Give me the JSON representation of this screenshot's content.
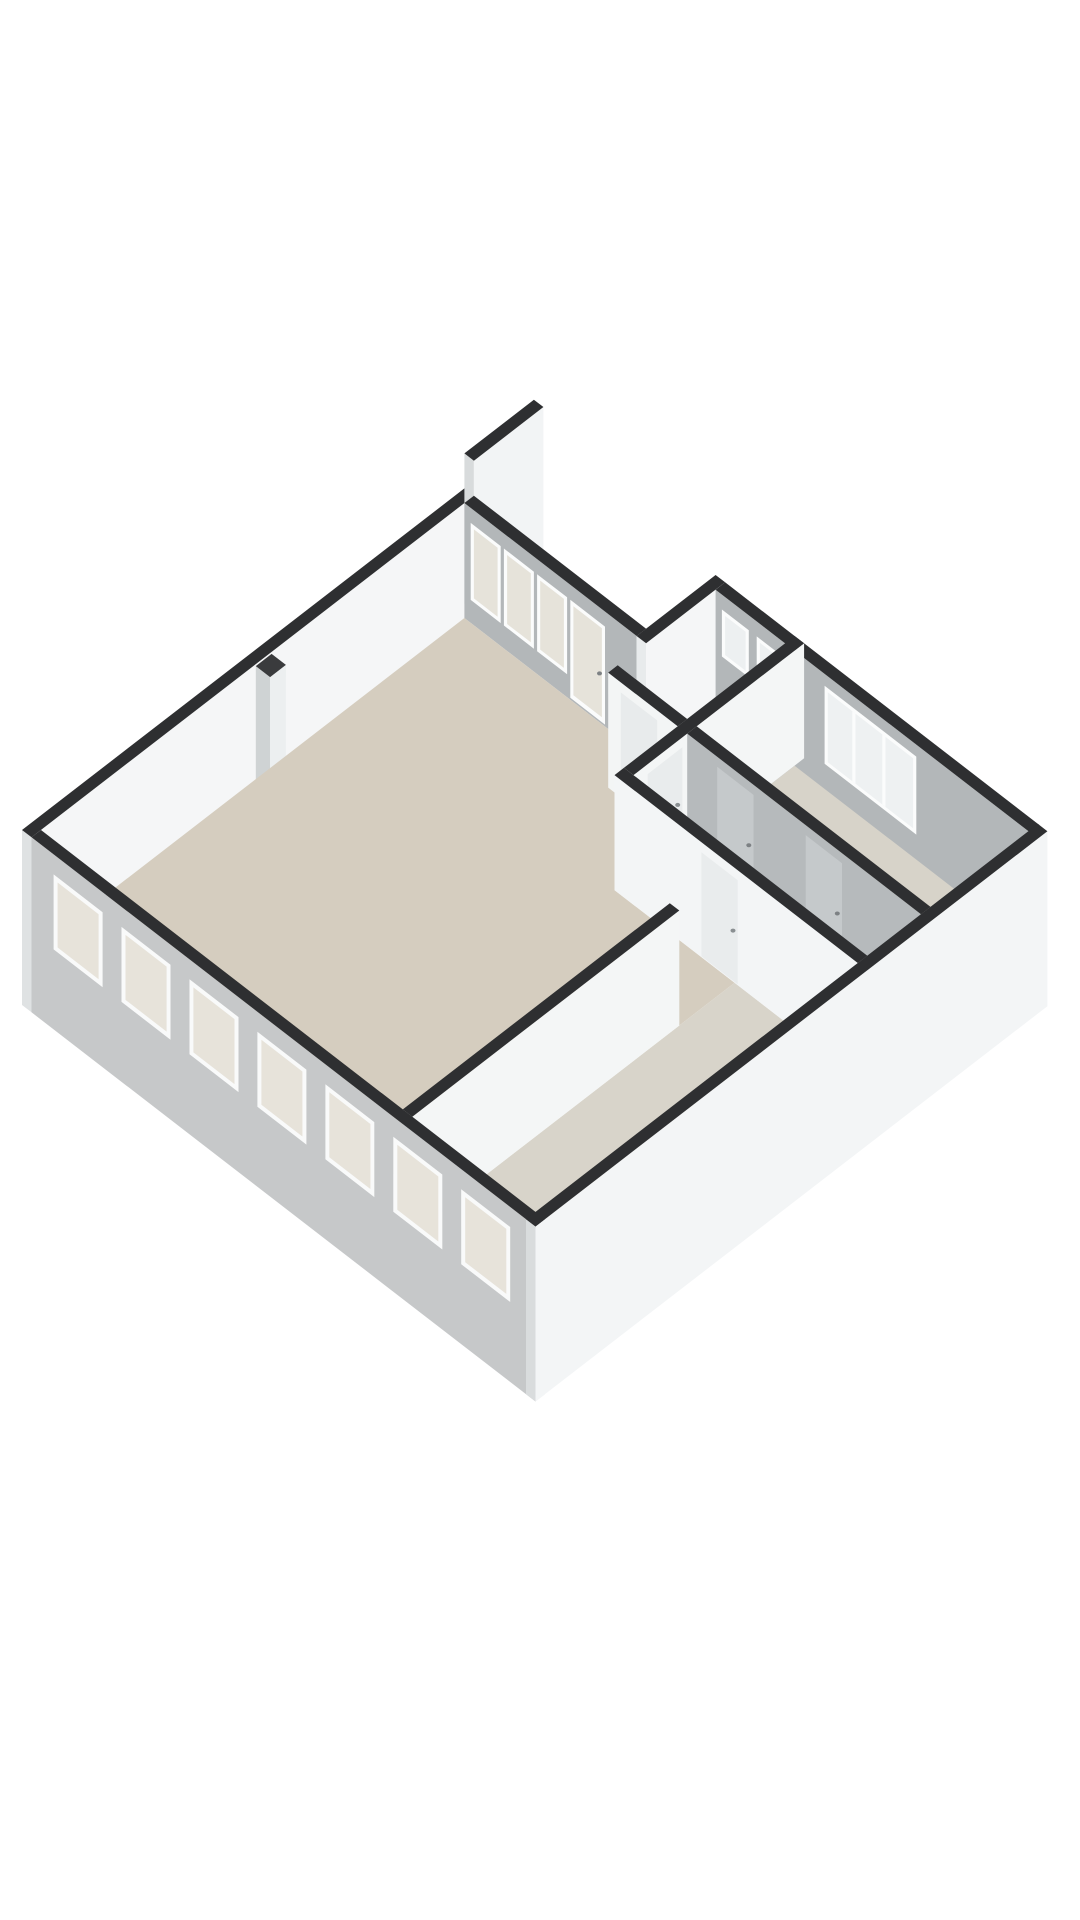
{
  "document": {
    "kind": "3d-floorplan-render",
    "description": "Isometric 3D floor plan of an apartment, no labels"
  },
  "canvas": {
    "width": 1080,
    "height": 1920,
    "background": "#ffffff"
  },
  "projection": {
    "x0": 22,
    "y0": 830,
    "cx": 0.79,
    "sy": 0.61,
    "floor_z": 115
  },
  "palette": {
    "wall_top": "#2e2f31",
    "wall_white": "#f4f6f6",
    "wall_gray": "#b3b7b9",
    "exterior_gray": "#c6c8c9",
    "floor_living": "#d5cdbf",
    "floor_rooms": "#d8d4ca",
    "glass_warm": "#e6e3da",
    "glass_cool": "#eef1f2",
    "frame_white": "#fbfcfc"
  },
  "shapes": [
    {
      "type": "prism",
      "name": "wall-northwest-exterior",
      "a1": 0,
      "b1": 0,
      "a2": 560,
      "b2": 12,
      "h": 115,
      "drop": 60,
      "cSW": "#dfe2e3",
      "cSE": "#f5f6f7",
      "cTop": "#2e2f31"
    },
    {
      "type": "prism",
      "name": "wall-party-stub",
      "a1": 560,
      "b1": 0,
      "a2": 648,
      "b2": 12,
      "h": 150,
      "drop": 0,
      "cSW": "#d8dbdc",
      "cSE": "#f2f4f5",
      "cTop": "#2e2f31"
    },
    {
      "type": "prism",
      "name": "wall-duct-notch",
      "a1": 284,
      "b1": 12,
      "a2": 304,
      "b2": 30,
      "h": 113,
      "cSW": "#cfd3d4",
      "cSE": "#eceff0",
      "cTop": "#3a3b3d"
    },
    {
      "type": "prism",
      "name": "wall-livingroom-window-band",
      "a1": 548,
      "b1": 12,
      "a2": 560,
      "b2": 230,
      "h": 115,
      "cSW": "#b3b7b9",
      "cSE": "#f2f4f5",
      "cTop": "#2e2f31"
    },
    {
      "type": "panel",
      "name": "window-frame",
      "plane": "a",
      "at": 548,
      "t1": 20,
      "t2": 58,
      "z1": 15,
      "z2": 92,
      "fill": "#fbfcfc"
    },
    {
      "type": "panel",
      "name": "window-glass",
      "plane": "a",
      "at": 548,
      "t1": 24,
      "t2": 54,
      "z1": 19,
      "z2": 88,
      "fill": "#e6e3da"
    },
    {
      "type": "panel",
      "name": "window-frame",
      "plane": "a",
      "at": 548,
      "t1": 62,
      "t2": 100,
      "z1": 15,
      "z2": 92,
      "fill": "#fbfcfc"
    },
    {
      "type": "panel",
      "name": "window-glass",
      "plane": "a",
      "at": 548,
      "t1": 66,
      "t2": 96,
      "z1": 19,
      "z2": 88,
      "fill": "#e6e3da"
    },
    {
      "type": "panel",
      "name": "window-frame",
      "plane": "a",
      "at": 548,
      "t1": 104,
      "t2": 142,
      "z1": 15,
      "z2": 92,
      "fill": "#fbfcfc"
    },
    {
      "type": "panel",
      "name": "window-glass",
      "plane": "a",
      "at": 548,
      "t1": 108,
      "t2": 138,
      "z1": 19,
      "z2": 88,
      "fill": "#e6e3da"
    },
    {
      "type": "panel",
      "name": "glass-door-frame",
      "plane": "a",
      "at": 548,
      "t1": 146,
      "t2": 190,
      "z1": 15,
      "z2": 113,
      "fill": "#fbfcfc"
    },
    {
      "type": "panel",
      "name": "glass-door-glass",
      "plane": "a",
      "at": 548,
      "t1": 150,
      "t2": 186,
      "z1": 19,
      "z2": 108,
      "fill": "#e6e3da"
    },
    {
      "type": "dot",
      "name": "door-handle",
      "a": 548,
      "b": 183,
      "z": 66,
      "r": 2.5,
      "fill": "#7d8184"
    },
    {
      "type": "prism",
      "name": "wall-bathroom-northwest",
      "a1": 548,
      "b1": 230,
      "a2": 648,
      "b2": 242,
      "h": 115,
      "cSW": "#e8ebec",
      "cSE": "#f5f6f7",
      "cTop": "#2e2f31"
    },
    {
      "type": "prism",
      "name": "wall-northeast-exterior",
      "a1": 636,
      "b1": 242,
      "a2": 648,
      "b2": 640,
      "h": 115,
      "drop": 60,
      "cSW": "#b3b7b9",
      "cSE": "#f2f4f5",
      "cTop": "#2e2f31"
    },
    {
      "type": "panel",
      "name": "bathroom-window-frame",
      "plane": "a",
      "at": 636,
      "t1": 250,
      "t2": 284,
      "z1": 15,
      "z2": 62,
      "fill": "#fbfcfc"
    },
    {
      "type": "panel",
      "name": "bathroom-window-glass",
      "plane": "a",
      "at": 636,
      "t1": 254,
      "t2": 280,
      "z1": 19,
      "z2": 58,
      "fill": "#edf0f1"
    },
    {
      "type": "panel",
      "name": "bathroom-window-frame",
      "plane": "a",
      "at": 636,
      "t1": 294,
      "t2": 328,
      "z1": 15,
      "z2": 62,
      "fill": "#fbfcfc"
    },
    {
      "type": "panel",
      "name": "bathroom-window-glass",
      "plane": "a",
      "at": 636,
      "t1": 298,
      "t2": 324,
      "z1": 19,
      "z2": 58,
      "fill": "#edf0f1"
    },
    {
      "type": "panel",
      "name": "bedroom-window-frame",
      "plane": "a",
      "at": 636,
      "t1": 380,
      "t2": 496,
      "z1": 12,
      "z2": 90,
      "fill": "#fbfcfc"
    },
    {
      "type": "panel",
      "name": "bedroom-window-glass",
      "plane": "a",
      "at": 636,
      "t1": 384,
      "t2": 492,
      "z1": 16,
      "z2": 86,
      "fill": "#eef1f2"
    },
    {
      "type": "panel",
      "name": "window-mullion",
      "plane": "a",
      "at": 636,
      "t1": 415,
      "t2": 419,
      "z1": 16,
      "z2": 86,
      "fill": "#fbfcfc"
    },
    {
      "type": "panel",
      "name": "window-mullion",
      "plane": "a",
      "at": 636,
      "t1": 453,
      "t2": 457,
      "z1": 16,
      "z2": 86,
      "fill": "#fbfcfc"
    },
    {
      "type": "floor",
      "name": "floor-living-room",
      "pts": [
        [
          12,
          12
        ],
        [
          548,
          12
        ],
        [
          548,
          330
        ],
        [
          420,
          330
        ],
        [
          420,
          482
        ],
        [
          350,
          482
        ],
        [
          350,
          470
        ],
        [
          12,
          470
        ]
      ],
      "fill": "#d5cdbf"
    },
    {
      "type": "floor",
      "name": "floor-bathroom",
      "pts": [
        [
          512,
          230
        ],
        [
          548,
          230
        ],
        [
          548,
          242
        ],
        [
          636,
          242
        ],
        [
          636,
          330
        ],
        [
          512,
          330
        ]
      ],
      "fill": "#ddd8cd"
    },
    {
      "type": "floor",
      "name": "floor-hallway",
      "pts": [
        [
          432,
          342
        ],
        [
          512,
          342
        ],
        [
          512,
          638
        ],
        [
          432,
          638
        ]
      ],
      "fill": "#d9d4ca"
    },
    {
      "type": "floor",
      "name": "floor-bedroom-right",
      "pts": [
        [
          512,
          342
        ],
        [
          636,
          342
        ],
        [
          636,
          638
        ],
        [
          512,
          638
        ]
      ],
      "fill": "#d7d3c9"
    },
    {
      "type": "floor",
      "name": "floor-bedroom-bottom",
      "pts": [
        [
          12,
          482
        ],
        [
          420,
          482
        ],
        [
          420,
          638
        ],
        [
          12,
          638
        ]
      ],
      "fill": "#d8d4ca"
    },
    {
      "type": "prism",
      "name": "shower-tray",
      "a1": 584,
      "b1": 246,
      "a2": 632,
      "b2": 294,
      "h": 8,
      "cSW": "#e4e6e6",
      "cSE": "#dcdedf",
      "cTop": "speckle"
    },
    {
      "type": "prism",
      "name": "bathroom-sink",
      "a1": 516,
      "b1": 296,
      "a2": 552,
      "b2": 318,
      "h": 30,
      "cSW": "#f7f9f9",
      "cSE": "#e9ecec",
      "cTop": "#fdfefe"
    },
    {
      "type": "dot",
      "name": "sink-tap",
      "a": 521,
      "b": 306,
      "z": 83,
      "r": 2.5,
      "fill": "#9aa0a3"
    },
    {
      "type": "prism",
      "name": "wall-bathroom-southwest",
      "a1": 500,
      "b1": 242,
      "a2": 512,
      "b2": 330,
      "h": 115,
      "cSW": "#f3f5f5",
      "cSE": "#eceff0",
      "cTop": "#2e2f31"
    },
    {
      "type": "panel",
      "name": "bathroom-door",
      "plane": "a",
      "at": 500,
      "t1": 258,
      "t2": 304,
      "z1": 10,
      "z2": 114,
      "fill": "#e8ebec"
    },
    {
      "type": "dot",
      "name": "door-handle",
      "a": 500,
      "b": 298,
      "z": 64,
      "r": 2.5,
      "fill": "#8a8f92"
    },
    {
      "type": "prism",
      "name": "wall-hall-north",
      "a1": 432,
      "b1": 330,
      "a2": 648,
      "b2": 342,
      "h": 115,
      "cSW": "#eef1f1",
      "cSE": "#f4f6f6",
      "cTop": "#2e2f31"
    },
    {
      "type": "panel",
      "name": "hall-door",
      "plane": "b",
      "at": 342,
      "t1": 450,
      "t2": 494,
      "z1": 10,
      "z2": 114,
      "fill": "#e9eced"
    },
    {
      "type": "dot",
      "name": "door-handle",
      "a": 488,
      "b": 342,
      "z": 64,
      "r": 2.5,
      "fill": "#8a8f92"
    },
    {
      "type": "prism",
      "name": "wall-hallway-east",
      "a1": 500,
      "b1": 342,
      "a2": 512,
      "b2": 638,
      "h": 115,
      "cSW": "#b6babc",
      "cSE": "#eef0f1",
      "cTop": "#2e2f31"
    },
    {
      "type": "panel",
      "name": "bedroom-door",
      "plane": "a",
      "at": 500,
      "t1": 380,
      "t2": 426,
      "z1": 10,
      "z2": 114,
      "fill": "#c5c9cb"
    },
    {
      "type": "dot",
      "name": "door-handle",
      "a": 500,
      "b": 420,
      "z": 64,
      "r": 2.5,
      "fill": "#7d8184"
    },
    {
      "type": "panel",
      "name": "closet-door",
      "plane": "a",
      "at": 500,
      "t1": 492,
      "t2": 538,
      "z1": 10,
      "z2": 114,
      "fill": "#c5c9cb"
    },
    {
      "type": "dot",
      "name": "door-handle",
      "a": 500,
      "b": 532,
      "z": 64,
      "r": 2.5,
      "fill": "#7d8184"
    },
    {
      "type": "prism",
      "name": "wall-hallway-west",
      "a1": 420,
      "b1": 330,
      "a2": 432,
      "b2": 638,
      "h": 115,
      "cSW": "#f3f5f6",
      "cSE": "#eef1f1",
      "cTop": "#2e2f31"
    },
    {
      "type": "panel",
      "name": "room-door",
      "plane": "a",
      "at": 420,
      "t1": 440,
      "t2": 486,
      "z1": 10,
      "z2": 114,
      "fill": "#e9eced"
    },
    {
      "type": "dot",
      "name": "door-handle",
      "a": 420,
      "b": 480,
      "z": 64,
      "r": 2.5,
      "fill": "#8a8f92"
    },
    {
      "type": "prism",
      "name": "wall-bedroom-bottom-north",
      "a1": 12,
      "b1": 470,
      "a2": 350,
      "b2": 482,
      "h": 115,
      "cSW": "#e8ebec",
      "cSE": "#f4f6f6",
      "cTop": "#2e2f31"
    },
    {
      "type": "prism",
      "name": "wall-southwest-exterior",
      "a1": 0,
      "b1": 12,
      "a2": 12,
      "b2": 650,
      "h": 115,
      "drop": 60,
      "cSW": "#c6c8c9",
      "cSE": "#eef0f1",
      "cTop": "#2e2f31"
    },
    {
      "type": "panel",
      "name": "facade-window-frame",
      "plane": "a",
      "at": 0,
      "t1": 40,
      "t2": 102,
      "z1": 20,
      "z2": 95,
      "fill": "#f9fafa"
    },
    {
      "type": "panel",
      "name": "facade-window-glass",
      "plane": "a",
      "at": 0,
      "t1": 45,
      "t2": 97,
      "z1": 25,
      "z2": 90,
      "fill": "#e7e3da"
    },
    {
      "type": "panel",
      "name": "facade-window-frame",
      "plane": "a",
      "at": 0,
      "t1": 126,
      "t2": 188,
      "z1": 20,
      "z2": 95,
      "fill": "#f9fafa"
    },
    {
      "type": "panel",
      "name": "facade-window-glass",
      "plane": "a",
      "at": 0,
      "t1": 131,
      "t2": 183,
      "z1": 25,
      "z2": 90,
      "fill": "#e7e3da"
    },
    {
      "type": "panel",
      "name": "facade-window-frame",
      "plane": "a",
      "at": 0,
      "t1": 212,
      "t2": 274,
      "z1": 20,
      "z2": 95,
      "fill": "#f9fafa"
    },
    {
      "type": "panel",
      "name": "facade-window-glass",
      "plane": "a",
      "at": 0,
      "t1": 217,
      "t2": 269,
      "z1": 25,
      "z2": 90,
      "fill": "#e7e3da"
    },
    {
      "type": "panel",
      "name": "facade-window-frame",
      "plane": "a",
      "at": 0,
      "t1": 298,
      "t2": 360,
      "z1": 20,
      "z2": 95,
      "fill": "#f9fafa"
    },
    {
      "type": "panel",
      "name": "facade-window-glass",
      "plane": "a",
      "at": 0,
      "t1": 303,
      "t2": 355,
      "z1": 25,
      "z2": 90,
      "fill": "#e7e3da"
    },
    {
      "type": "panel",
      "name": "facade-window-frame",
      "plane": "a",
      "at": 0,
      "t1": 384,
      "t2": 446,
      "z1": 20,
      "z2": 95,
      "fill": "#f9fafa"
    },
    {
      "type": "panel",
      "name": "facade-window-glass",
      "plane": "a",
      "at": 0,
      "t1": 389,
      "t2": 441,
      "z1": 25,
      "z2": 90,
      "fill": "#e7e3da"
    },
    {
      "type": "panel",
      "name": "facade-window-frame",
      "plane": "a",
      "at": 0,
      "t1": 470,
      "t2": 532,
      "z1": 20,
      "z2": 95,
      "fill": "#f9fafa"
    },
    {
      "type": "panel",
      "name": "facade-window-glass",
      "plane": "a",
      "at": 0,
      "t1": 475,
      "t2": 527,
      "z1": 25,
      "z2": 90,
      "fill": "#e7e3da"
    },
    {
      "type": "panel",
      "name": "facade-window-frame",
      "plane": "a",
      "at": 0,
      "t1": 556,
      "t2": 618,
      "z1": 20,
      "z2": 95,
      "fill": "#f9fafa"
    },
    {
      "type": "panel",
      "name": "facade-window-glass",
      "plane": "a",
      "at": 0,
      "t1": 561,
      "t2": 613,
      "z1": 25,
      "z2": 90,
      "fill": "#e7e3da"
    },
    {
      "type": "prism",
      "name": "wall-southeast-exterior",
      "a1": 0,
      "b1": 638,
      "a2": 648,
      "b2": 650,
      "h": 115,
      "drop": 60,
      "cSW": "#d9dcdd",
      "cSE": "#f3f5f6",
      "cTop": "#2e2f31"
    }
  ]
}
